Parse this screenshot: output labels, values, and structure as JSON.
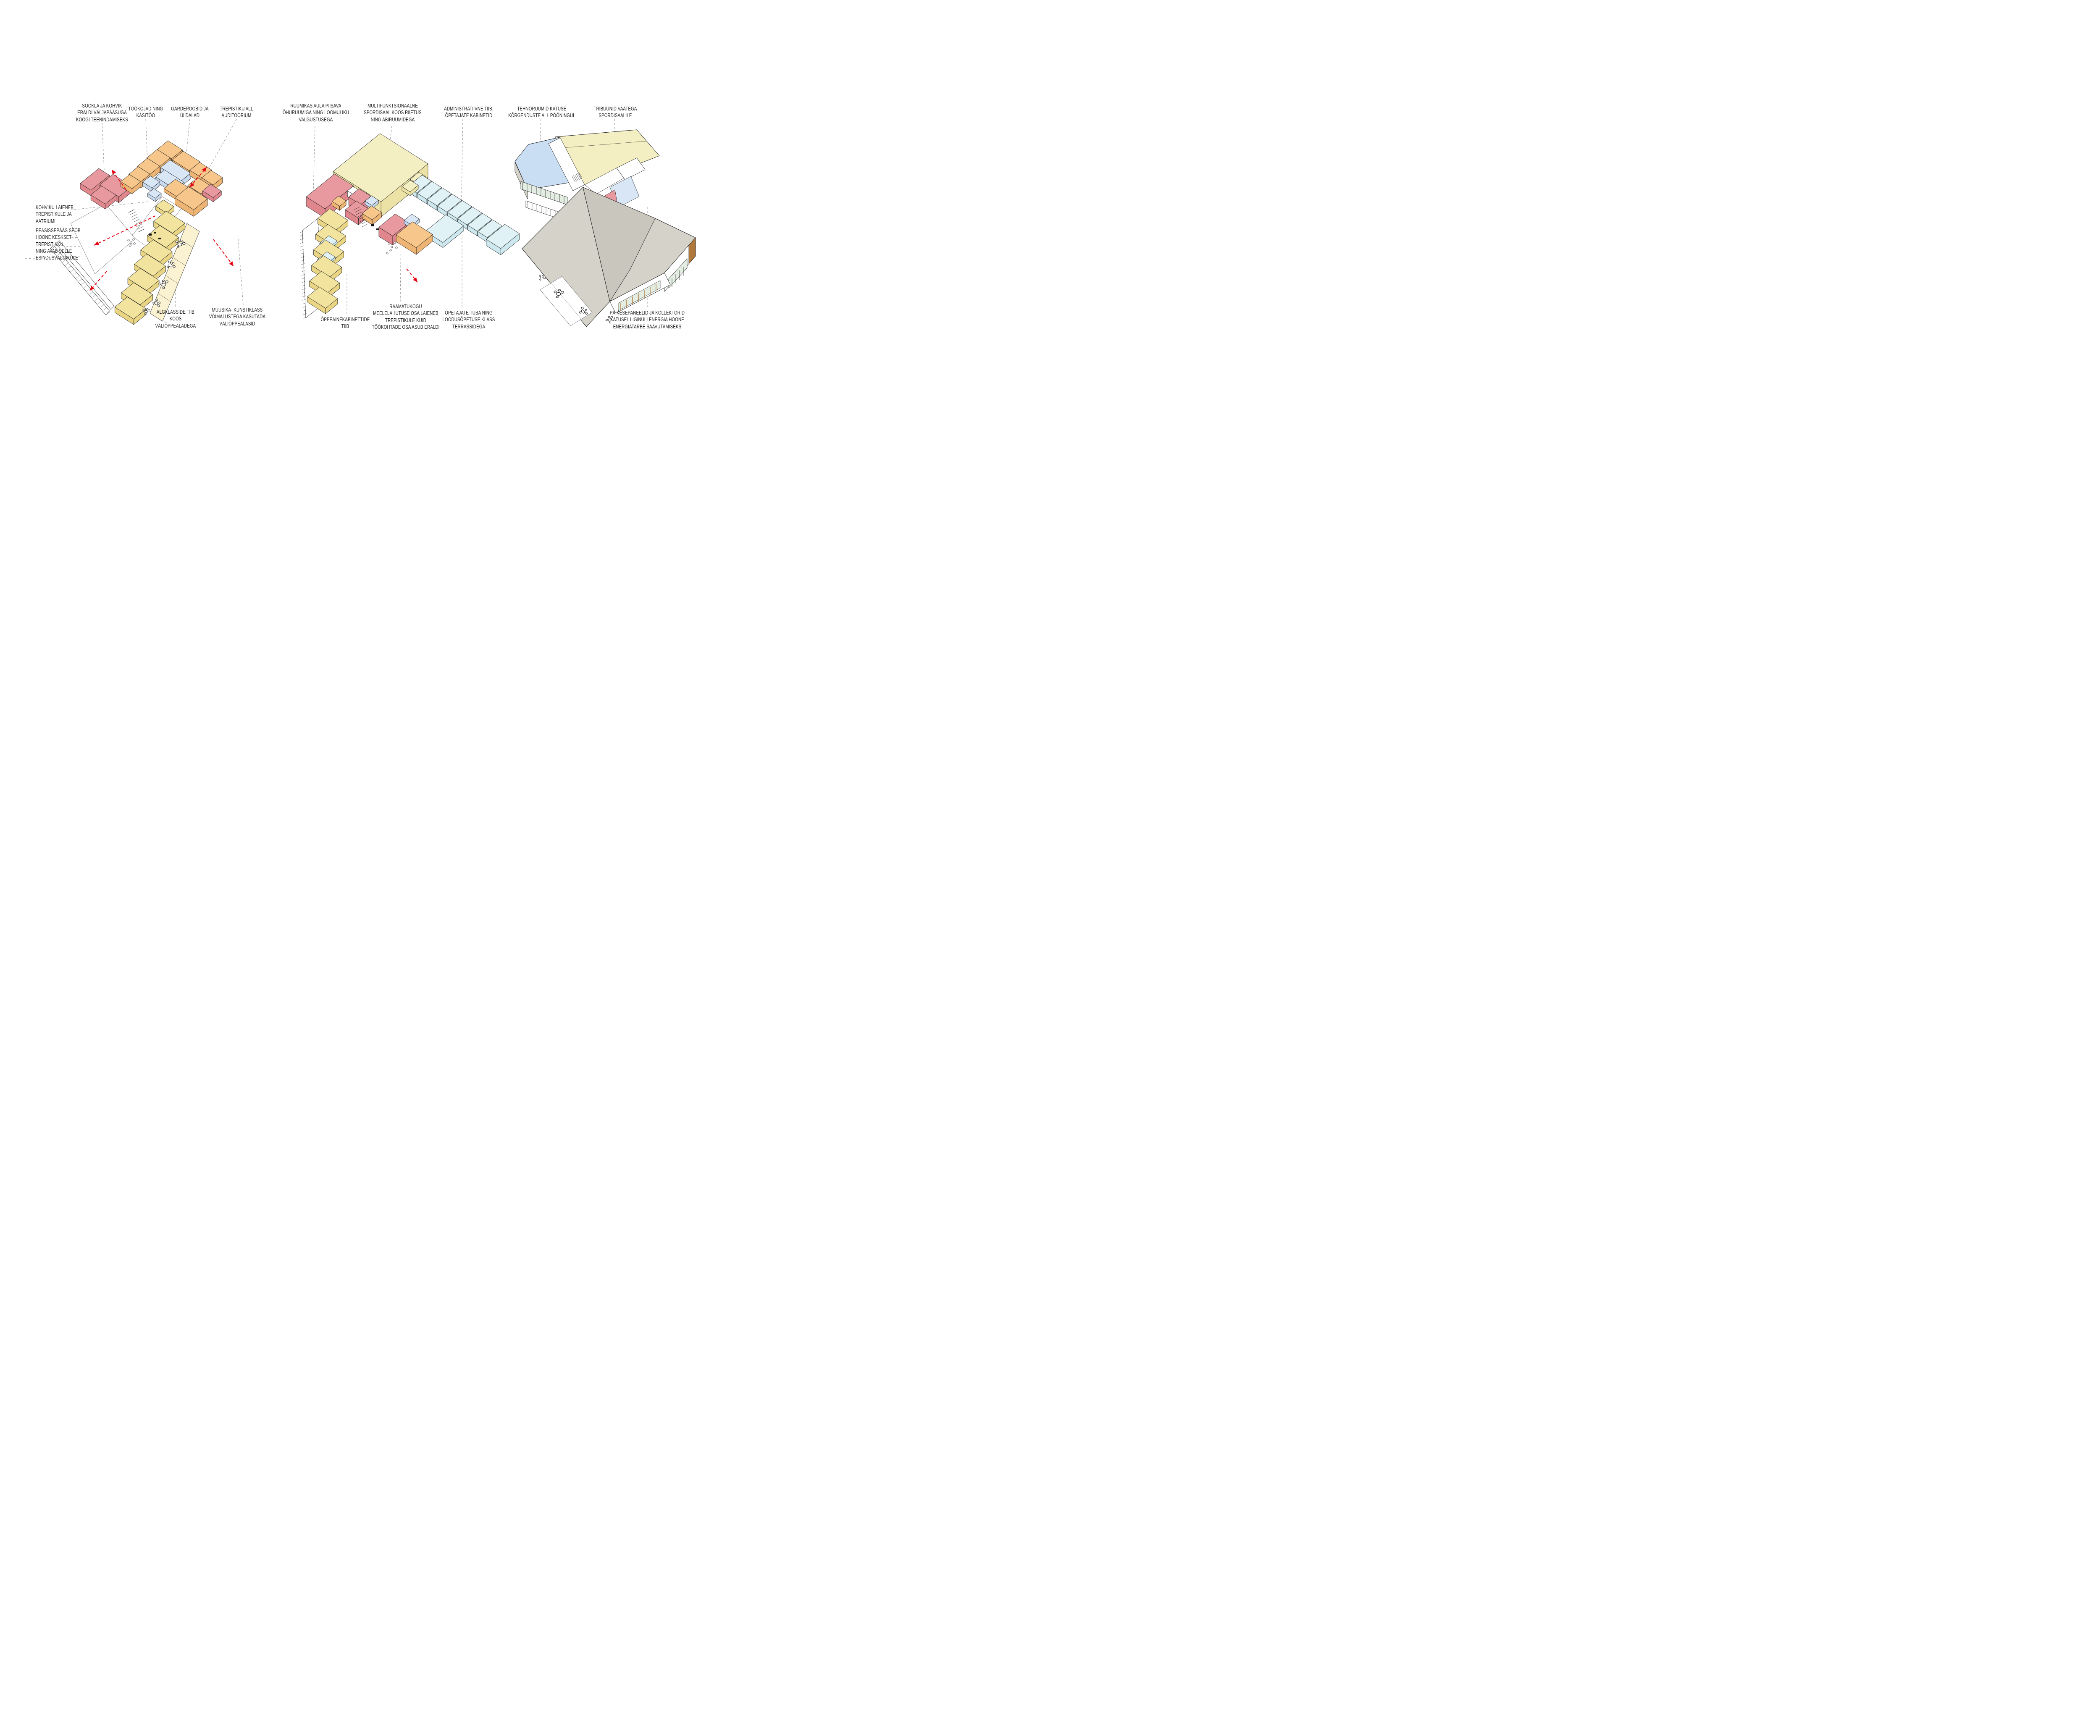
{
  "colors": {
    "ink": "#1a1a1a",
    "leader_gray": "#8a8a8a",
    "accent_red": "#e30613",
    "white": "#ffffff",
    "orange": "#f6c68b",
    "orange_side": "#eeb473",
    "salmon": "#e8999f",
    "salmon_side": "#e0878d",
    "blue": "#d8e6f6",
    "blue_side": "#c6d9ef",
    "yellow": "#f2e49e",
    "yellow_side": "#e9d584",
    "cream": "#faf2d0",
    "hall": "#f4efc3",
    "hall_side": "#ece2a6",
    "cyan": "#e0f2f6",
    "cyan_side": "#cde8ee",
    "roof_gray": "#d5d2ca",
    "roof_gray_dark": "#c9c6bd",
    "roof_blue": "#c9ddf3",
    "glass": "#e3ede2",
    "wood": "#b0793b",
    "beige": "#e9dfc0"
  },
  "labels": {
    "sookla": "SÖÖKLA JA KOHVIK\nERALDI VÄLJAPÄÄSUGA\nKÖÖGI TEENINDAMISEKS",
    "tookojad": "TÖÖKOJAD NING\nKÄSITÖÖ",
    "garderoobid": "GARDEROOBID JA\nÜLDALAD",
    "trepistiku": "TREPISTIKU ALL\nAUDITOORIUM",
    "kohviku": "KOHVIKU LAIENEB\nTREPISTIKULE JA\nAATRIUMI",
    "peasissepaas": "PEASISSEPÄÄS SEOB\nHOONE KESKSET\nTREPISTIKKU\nNING AVAB SELLE\nESINDUSVÄLJAKULE",
    "algklasside": "ALGKLASSIDE TIIB\nKOOS\nVÄLIÕPPEALADEGA",
    "muusika": "MUUSIKA- KUNSTIKLASS\nVÕIMALUSTEGA KASUTADA\nVÄLIÕPPEALASID",
    "ruumikas": "RUUMIKAS AULA PIISAVA\nÕHURUUMIGA NING LOOMULIKU\nVALGUSTUSEGA",
    "multifunktsionaalne": "MULTIFUNKTSIONAALNE\nSPORDISAAL KOOS RIIETUS\nNING ABIRUUMIDEGA",
    "administratiivne": "ADMINISTRATIIVNE TIIB,\nÕPETAJATE KABINETID",
    "oppeaine": "ÕPPEAINEKABINETTIDE\nTIIB",
    "raamatukogu": "RAAMATUKOGU\nMEELELAHUTUSE OSA LAIENEB\nTREPISTIKULE KUID\nTÖÖKOHTADE OSA ASUB ERALDI",
    "opetajate_tuba": "ÕPETAJATE TUBA NING\nLOODUSÕPETUSE KLASS\nTERRASSIDEGA",
    "tehnoruumid": "TEHNORUUMID KATUSE\nKÕRGENDUSTE ALL PÖÖNINGUL",
    "tribuunid": "TRIBÜÜNID VAATEGA\nSPORDISAALILE",
    "paikesepaneelid": "PÄIKESEPANEELID JA KOLLEKTORID\nKATUSEL LIGINULLENERGIA HOONE\nENERGIATARBE SAAVUTAMISEKS"
  }
}
